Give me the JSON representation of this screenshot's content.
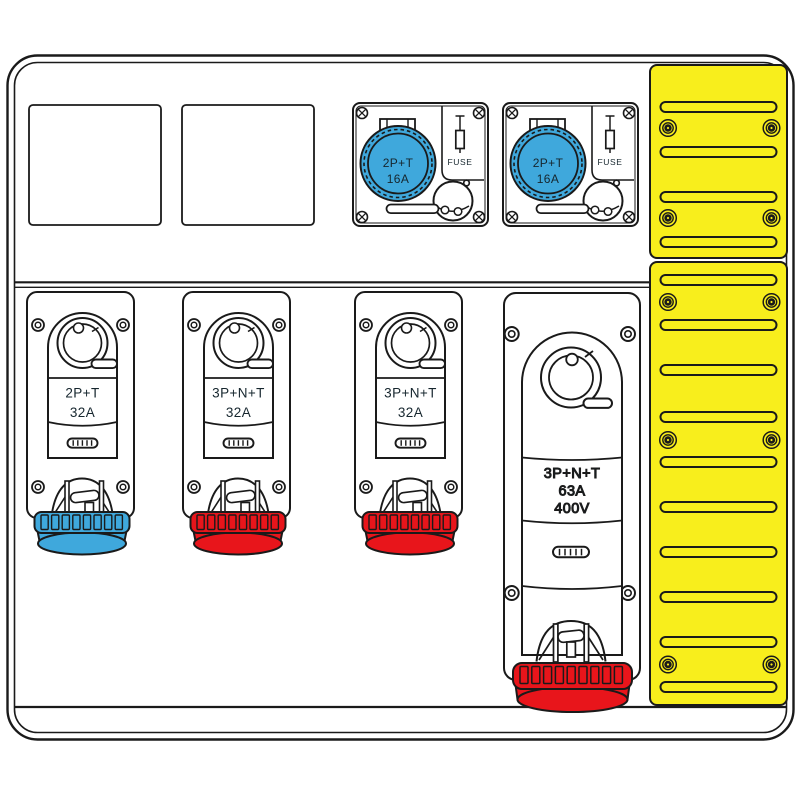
{
  "diagram": {
    "title": "electrical distribution board wiring-accessory layout diagram",
    "colors": {
      "blue": "#3FA8DC",
      "red": "#E8151B",
      "yellow": "#F8EE1C",
      "line": "#1a1a1a"
    },
    "top_units": {
      "a": {
        "rating_line1": "2P+T",
        "rating_line2": "16A",
        "fuse_label": "FUSE"
      },
      "b": {
        "rating_line1": "2P+T",
        "rating_line2": "16A",
        "fuse_label": "FUSE"
      }
    },
    "bottom_units": {
      "u1": {
        "rating_line1": "2P+T",
        "rating_line2": "32A"
      },
      "u2": {
        "rating_line1": "3P+N+T",
        "rating_line2": "32A"
      },
      "u3": {
        "rating_line1": "3P+N+T",
        "rating_line2": "32A"
      },
      "u4": {
        "rating_line1": "3P+N+T",
        "rating_line2": "63A",
        "rating_line3": "400V"
      }
    }
  }
}
